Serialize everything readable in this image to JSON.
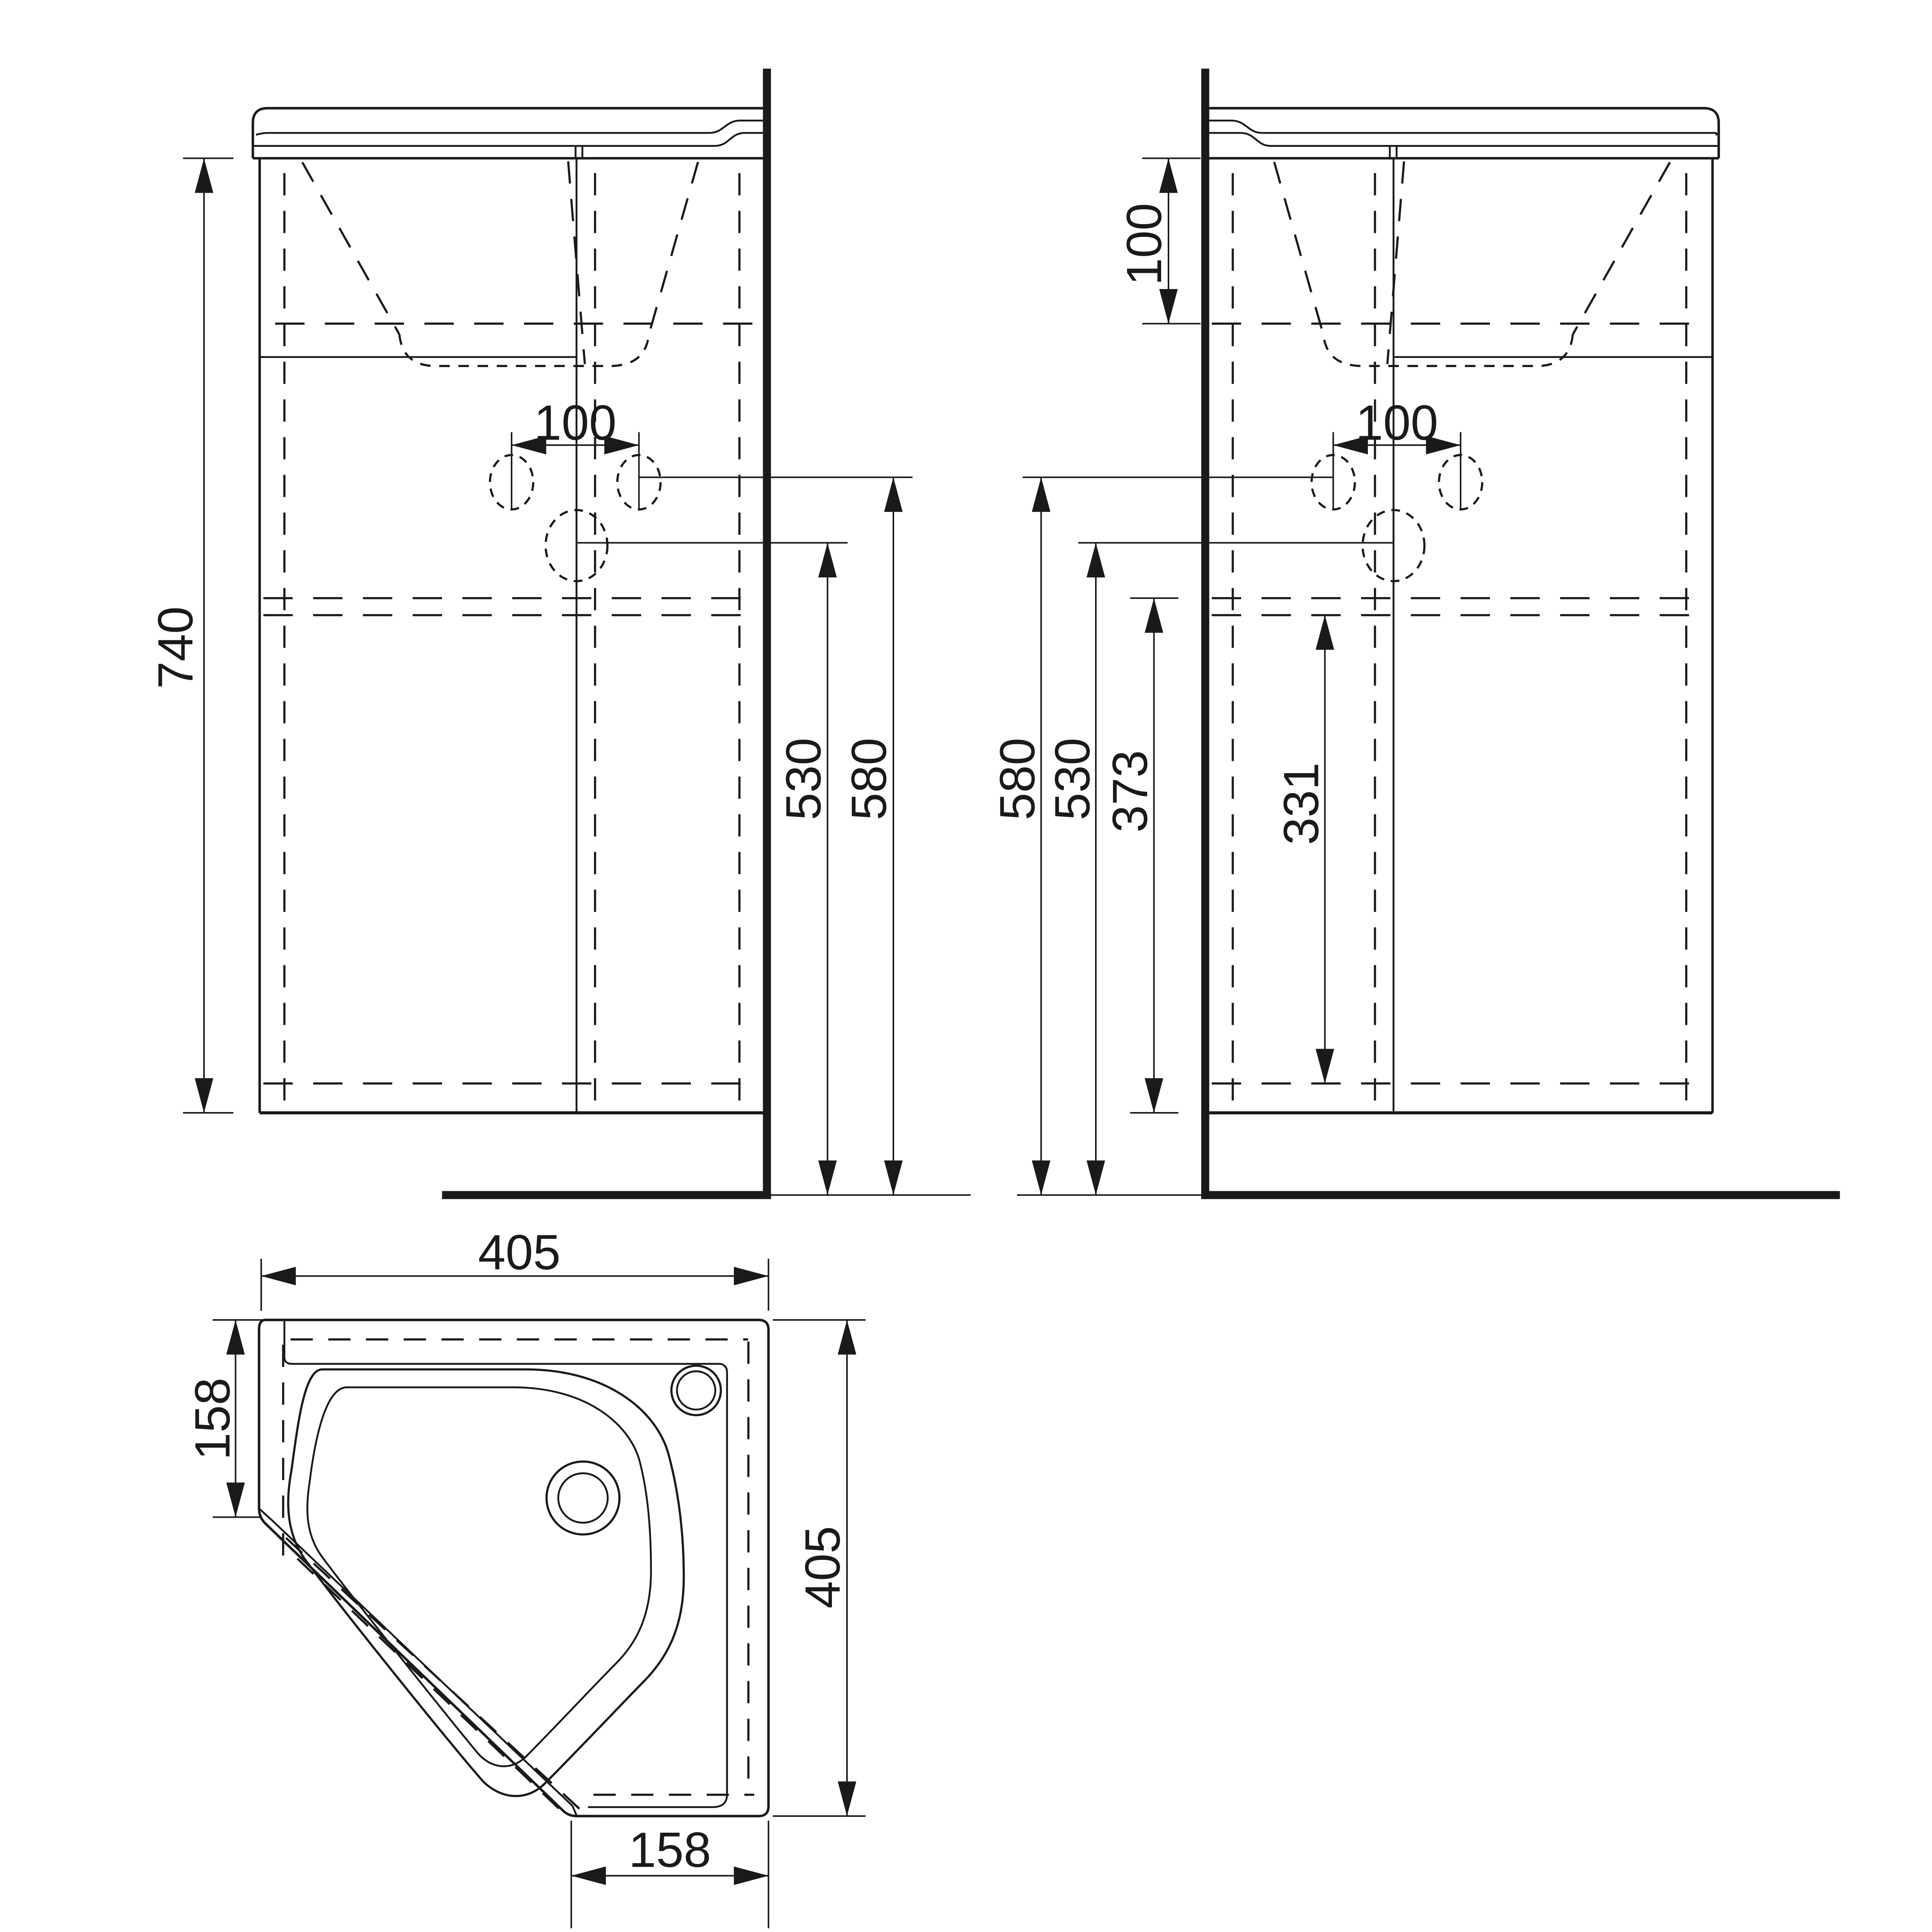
{
  "page": {
    "background": "#ffffff",
    "line_color": "#1a1a1a",
    "content": "technical dimension drawing of a corner washbasin vanity unit: two front/side elevation views against a wall and one plan (top) view"
  },
  "views": {
    "front_left": {
      "label": "elevation view, wall on right",
      "dims": {
        "height": "740",
        "faucet_spacing": "100",
        "drain_height": "530",
        "faucet_height": "580"
      }
    },
    "front_right": {
      "label": "elevation view, wall on left",
      "dims": {
        "basin_depth": "100",
        "faucet_spacing": "100",
        "faucet_height": "580",
        "drain_height": "530",
        "cabinet_bottom_height": "373",
        "shelf_height": "331"
      }
    },
    "plan": {
      "label": "plan (top) view",
      "dims": {
        "width_top": "405",
        "side_depth_left": "158",
        "depth_right": "405",
        "front_width_bottom": "158"
      }
    }
  }
}
